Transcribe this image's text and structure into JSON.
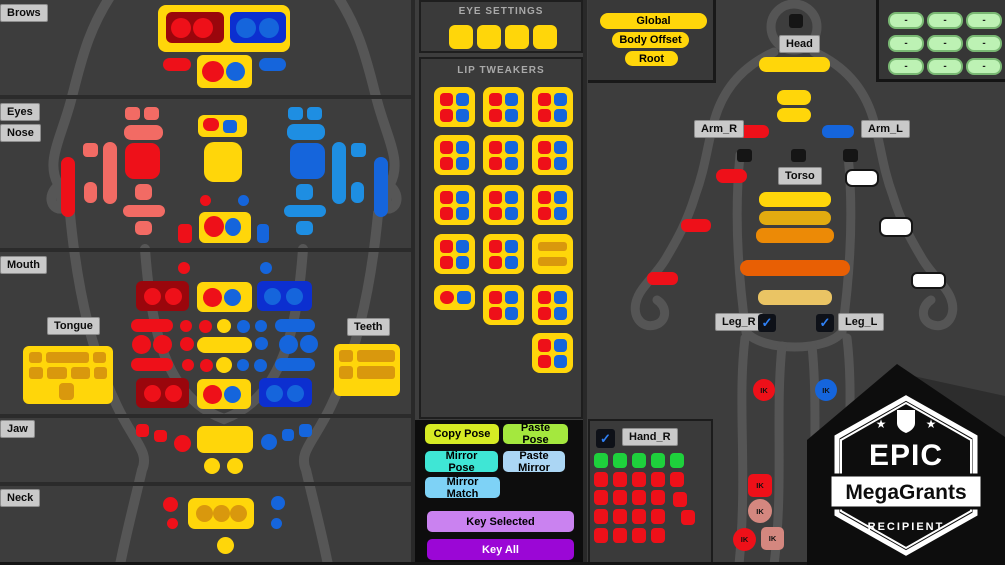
{
  "face_panel": {
    "labels": {
      "brows": "Brows",
      "eyes": "Eyes",
      "nose": "Nose",
      "mouth": "Mouth",
      "tongue": "Tongue",
      "teeth": "Teeth",
      "jaw": "Jaw",
      "neck": "Neck"
    }
  },
  "eye_settings": {
    "title": "EYE SETTINGS",
    "buttons": 4
  },
  "lip_tweakers": {
    "title": "LIP TWEAKERS",
    "rows": [
      [
        "quad",
        "quad",
        "quad"
      ],
      [
        "quad",
        "quad",
        "quad"
      ],
      [
        "quad",
        "quad",
        "quad"
      ],
      [
        "quad",
        "quad",
        "bars"
      ],
      [
        "pair",
        "quad",
        "quad"
      ],
      [
        "none",
        "none",
        "quad"
      ]
    ]
  },
  "pose_buttons": {
    "copy": "Copy Pose",
    "paste": "Paste Pose",
    "mirror": "Mirror Pose",
    "paste_mirror": "Paste Mirror",
    "mirror_match": "Mirror Match",
    "key_selected": "Key Selected",
    "key_all": "Key All"
  },
  "body_panel": {
    "root_controls": {
      "global": "Global",
      "body_offset": "Body Offset",
      "root": "Root"
    },
    "part_labels": {
      "head": "Head",
      "arm_r": "Arm_R",
      "arm_l": "Arm_L",
      "torso": "Torso",
      "leg_r": "Leg_R",
      "leg_l": "Leg_L",
      "hand_r": "Hand_R"
    },
    "checkboxes": {
      "leg_r": true,
      "leg_l": true,
      "hand_r": true
    },
    "ik_label": "IK"
  },
  "corner_grid": {
    "rows": 3,
    "cols": 3,
    "pill_label": "-"
  },
  "badge": {
    "title": "EPIC",
    "subtitle": "MegaGrants",
    "footer": "RECIPIENT"
  },
  "ui": {
    "check": "✓",
    "star": "★"
  },
  "palette": {
    "Y": "#ffd60a",
    "R": "#ee1019",
    "DR": "#9a060c",
    "SA": "#f26b64",
    "DB": "#0c2fd0",
    "B": "#1565dc",
    "LB": "#1e8ee2",
    "OR": "#d9980d",
    "W": "#ffffff",
    "BK": "#151515",
    "S2": "#e2ab10",
    "S3": "#ec8a06",
    "S4": "#e85f04",
    "S5": "#eac464",
    "HG": "#1ed13c",
    "PK": "#d4877f",
    "btn_copy": "#d6eb24",
    "btn_paste": "#a4e83e",
    "btn_mirror": "#3fe6d5",
    "btn_paste_mirror": "#abd6f4",
    "btn_mirror_match": "#7ed2f6",
    "btn_key_selected": "#ca82f0",
    "btn_key_all": "#9b07d6"
  }
}
